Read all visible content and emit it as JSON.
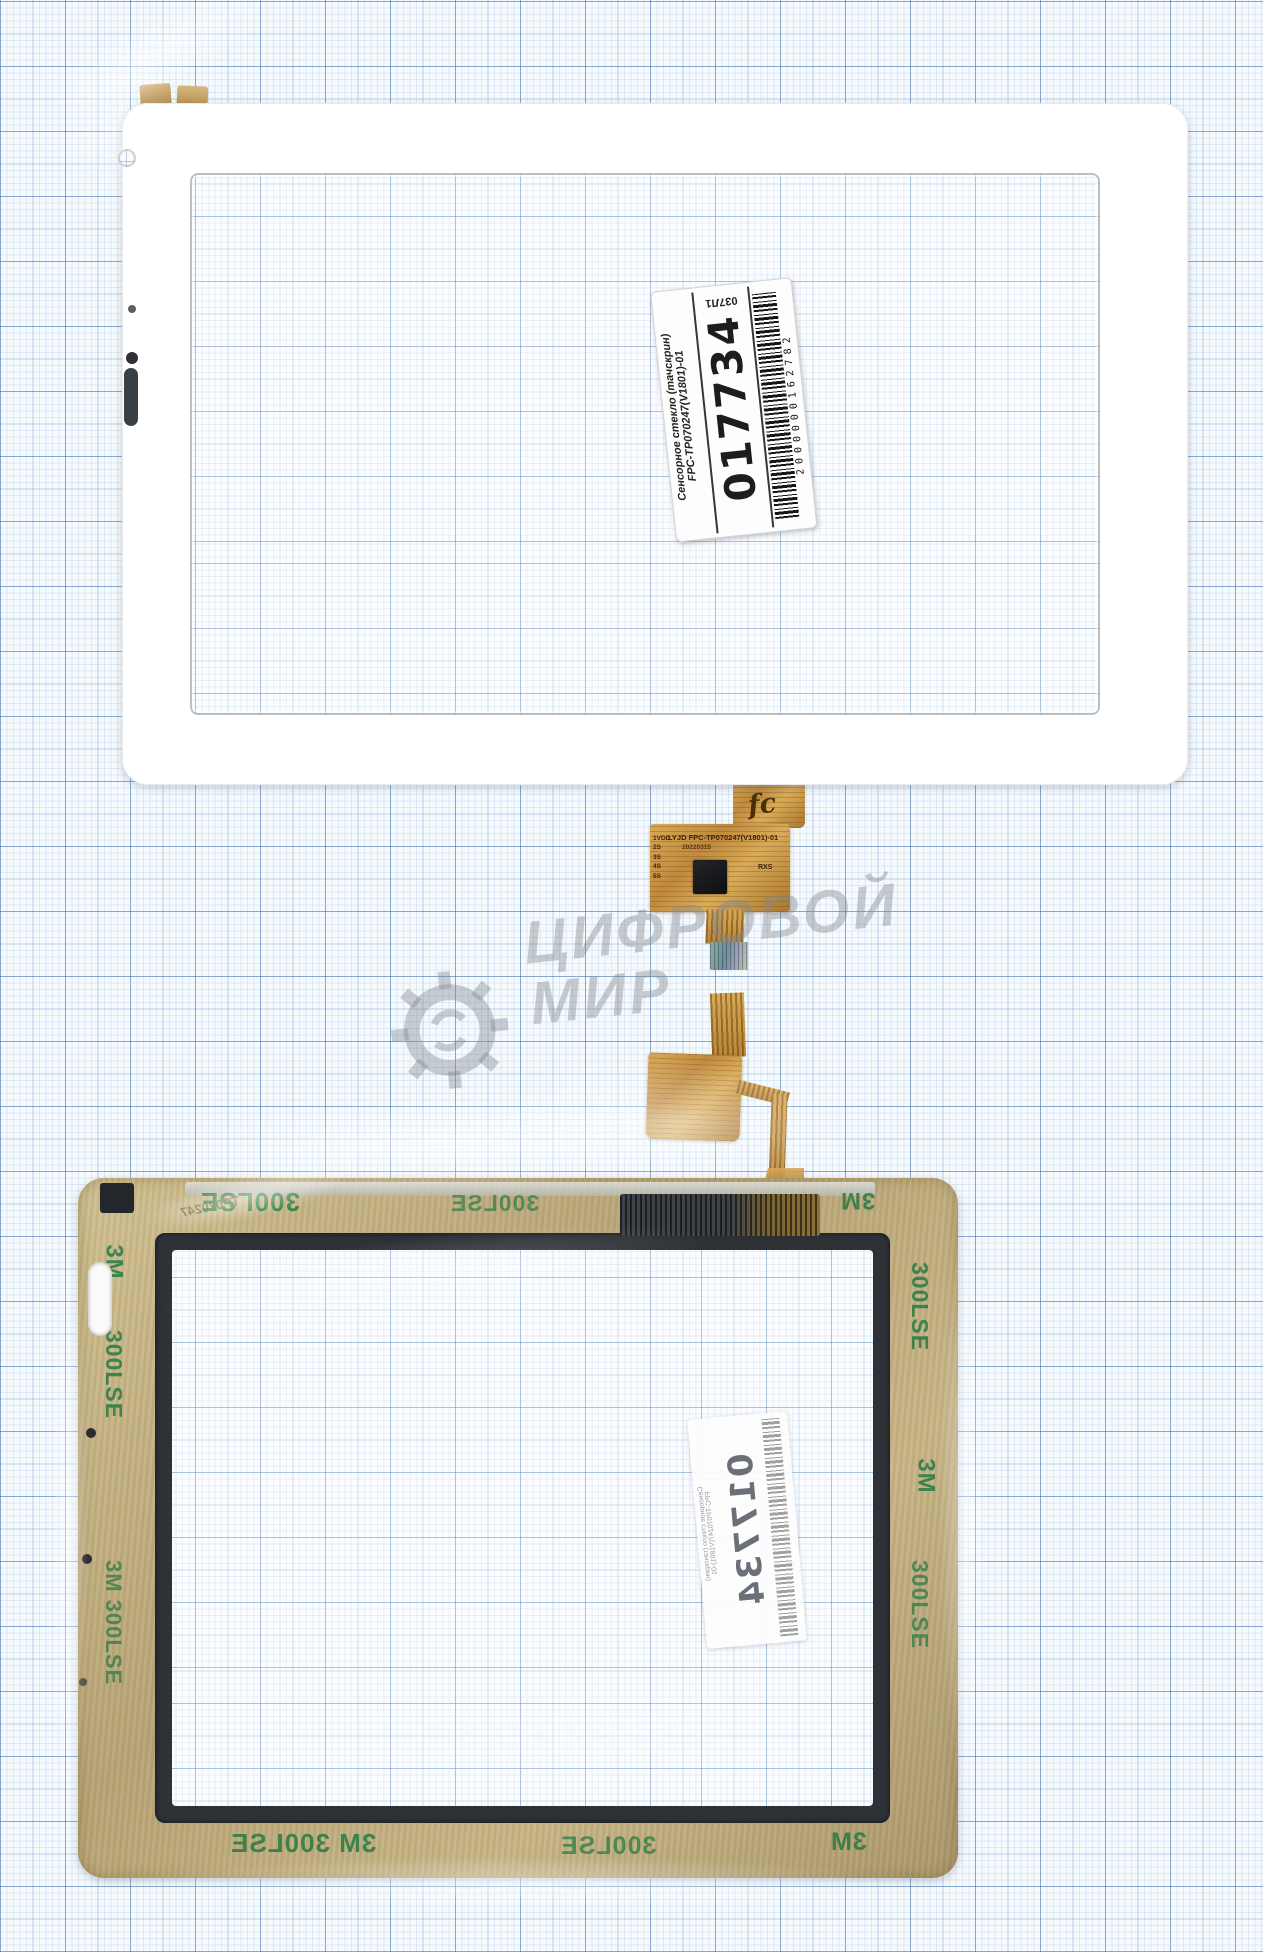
{
  "front_label": {
    "line1": "Сенсорное стекло (тачскрин)",
    "line2": "FPC-TP070247(V1801)-01",
    "number": "017734",
    "barcode_digits": "2000000162782",
    "top_code": "037Л1"
  },
  "flex1": {
    "vendor": "LYJD",
    "part": "FPC-TP070247(V1801)-01",
    "pins": "1VDD\n2S\n3S\n4S\n5S",
    "date": "20220315",
    "mark": "RXS",
    "logo": "fc"
  },
  "tape": {
    "brand": "3M",
    "code": "300LSE",
    "combo": "3M 300LSE",
    "mirrored_part": "TP070247"
  },
  "watermark": {
    "line1": "ЦИФРОВОЙ",
    "line2": "МИР"
  },
  "back_label": {
    "number": "017734",
    "line1": "Сенсорное стекло (тачскрин)",
    "line2": "FPC-TP070247(V1801)-01"
  },
  "colors": {
    "gold": "#c08a3e",
    "tape_tan": "#bfae7f",
    "tape_green": "#2f8b4f",
    "frame_dark": "#2e3236",
    "grid_blue": "#3a6ca5"
  }
}
